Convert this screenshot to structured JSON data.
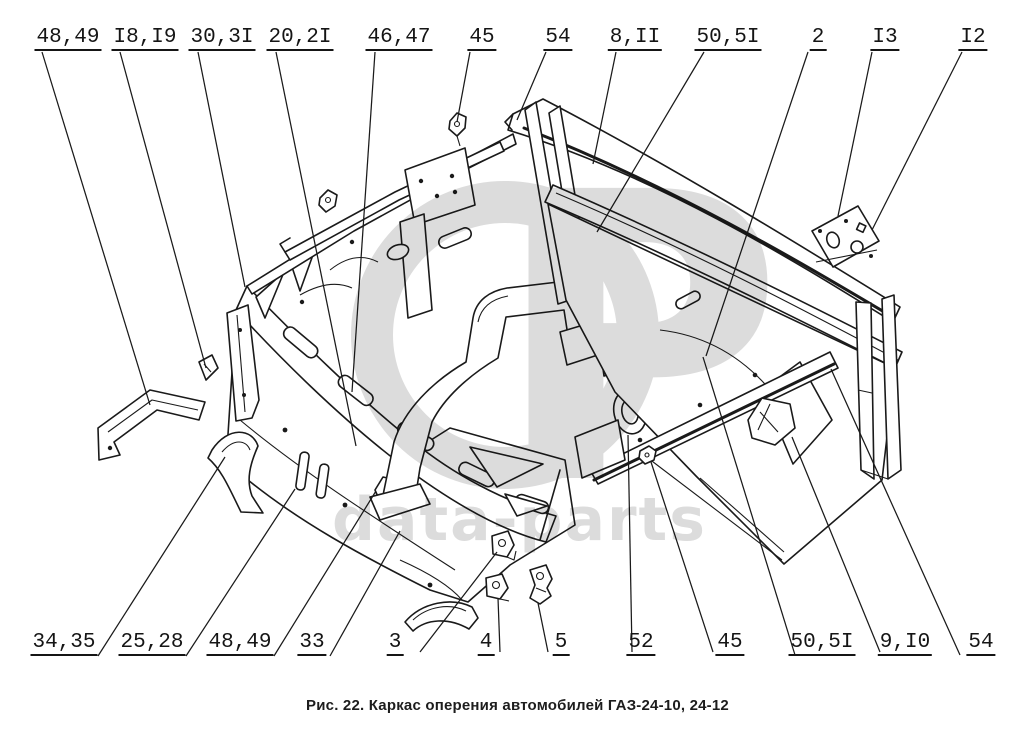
{
  "figure": {
    "caption": "Рис. 22. Каркас оперения автомобилей ГАЗ-24-10, 24-12",
    "watermark": {
      "letter": "P",
      "text": "data-parts",
      "color": "#dcdcdc"
    },
    "colors": {
      "line": "#1a1a1a",
      "background": "#ffffff",
      "watermark": "#dcdcdc"
    },
    "labels_top": [
      {
        "text": "48,49"
      },
      {
        "text": "I8,I9"
      },
      {
        "text": "30,3I"
      },
      {
        "text": "20,2I"
      },
      {
        "text": "46,47"
      },
      {
        "text": "45"
      },
      {
        "text": "54"
      },
      {
        "text": "8,II"
      },
      {
        "text": "50,5I"
      },
      {
        "text": "2"
      },
      {
        "text": "I3"
      },
      {
        "text": "I2"
      }
    ],
    "labels_bottom": [
      {
        "text": "34,35"
      },
      {
        "text": "25,28"
      },
      {
        "text": "48,49"
      },
      {
        "text": "33"
      },
      {
        "text": "3"
      },
      {
        "text": "4"
      },
      {
        "text": "5"
      },
      {
        "text": "52"
      },
      {
        "text": "45"
      },
      {
        "text": "50,5I"
      },
      {
        "text": "9,I0"
      },
      {
        "text": "54"
      }
    ]
  }
}
